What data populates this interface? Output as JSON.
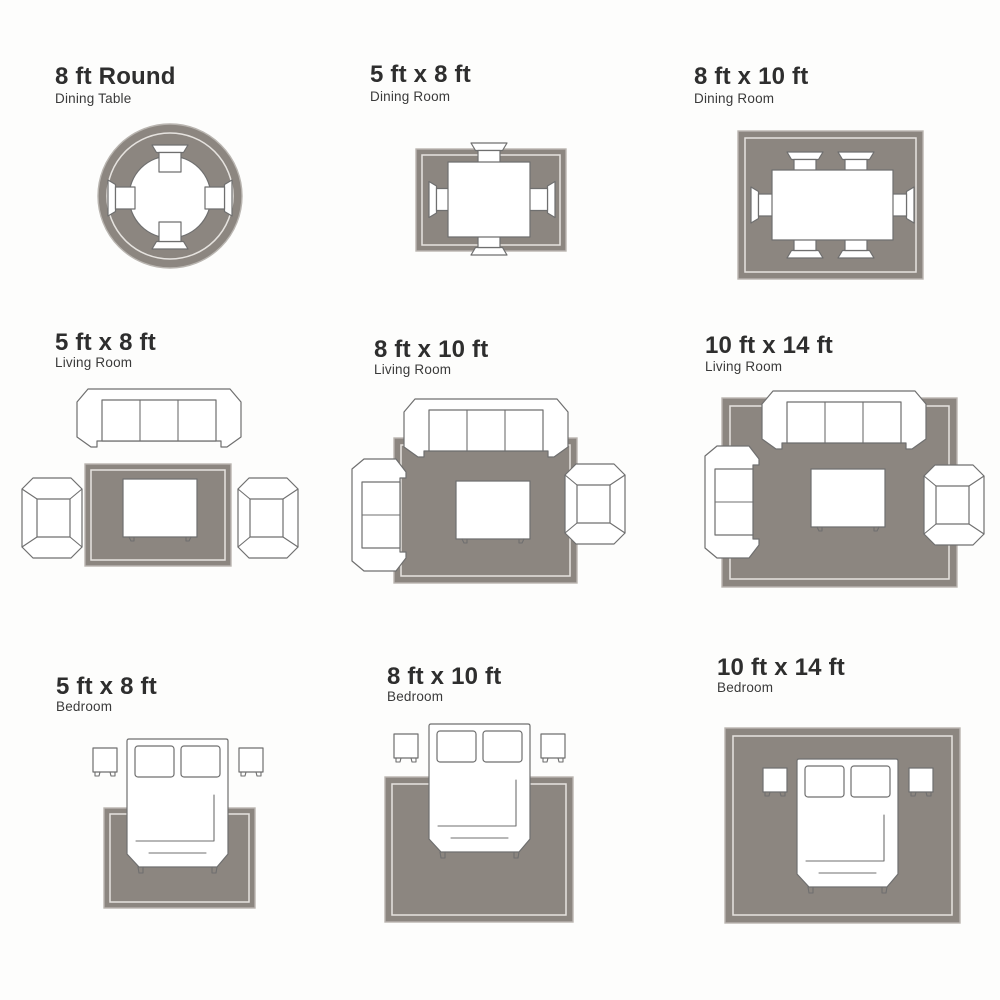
{
  "colors": {
    "background": "#fdfdfc",
    "rug_fill": "#8c8680",
    "rug_outer_edge": "#b9b5b0",
    "rug_inner_line": "#e6e3df",
    "furniture_fill": "#ffffff",
    "furniture_outline": "#6f6f6f",
    "title_text": "#2e2e2e",
    "subtitle_text": "#3a3a3a"
  },
  "panels": [
    {
      "title": "8 ft Round",
      "subtitle": "Dining Table",
      "rug_shape": "round",
      "furniture": {
        "round_dining_table": 1,
        "dining_chairs": 4
      }
    },
    {
      "title": "5 ft x 8 ft",
      "subtitle": "Dining Room",
      "rug_shape": "rectangle",
      "furniture": {
        "dining_table": 1,
        "dining_chairs": 4
      }
    },
    {
      "title": "8 ft x 10 ft",
      "subtitle": "Dining Room",
      "rug_shape": "rectangle",
      "furniture": {
        "dining_table": 1,
        "dining_chairs": 6
      }
    },
    {
      "title": "5 ft x 8 ft",
      "subtitle": "Living Room",
      "rug_shape": "rectangle",
      "furniture": {
        "sofa": 1,
        "armchairs": 2,
        "coffee_table": 1
      }
    },
    {
      "title": "8 ft x 10 ft",
      "subtitle": "Living Room",
      "rug_shape": "rectangle",
      "furniture": {
        "sofa": 1,
        "loveseat": 1,
        "armchair": 1,
        "coffee_table": 1
      }
    },
    {
      "title": "10 ft x 14 ft",
      "subtitle": "Living Room",
      "rug_shape": "rectangle",
      "furniture": {
        "sofa": 1,
        "loveseat": 1,
        "armchair": 1,
        "coffee_table": 1
      }
    },
    {
      "title": "5 ft x 8 ft",
      "subtitle": "Bedroom",
      "rug_shape": "rectangle",
      "furniture": {
        "bed": 1,
        "nightstands": 2
      }
    },
    {
      "title": "8 ft x 10 ft",
      "subtitle": "Bedroom",
      "rug_shape": "rectangle",
      "furniture": {
        "bed": 1,
        "nightstands": 2
      }
    },
    {
      "title": "10 ft x 14 ft",
      "subtitle": "Bedroom",
      "rug_shape": "rectangle",
      "furniture": {
        "bed": 1,
        "nightstands": 2
      }
    }
  ]
}
